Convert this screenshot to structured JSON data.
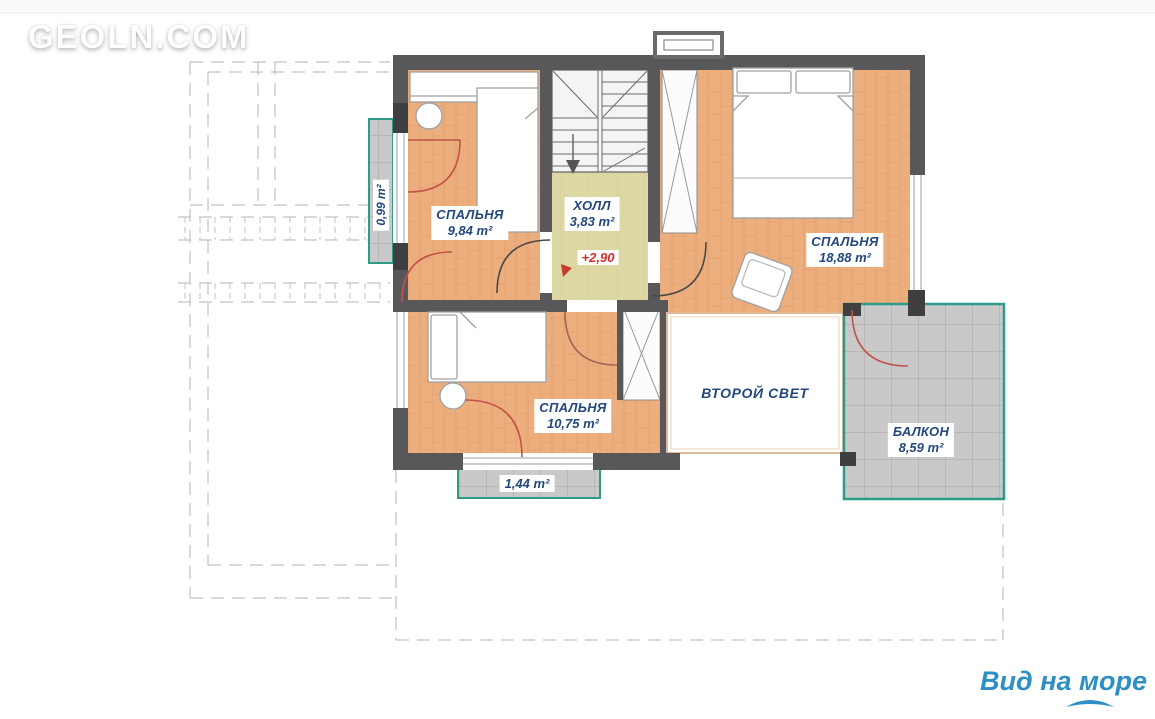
{
  "watermark": {
    "text": "GEOLN.COM"
  },
  "plan": {
    "rooms": {
      "bedroom_top_left": {
        "name": "СПАЛЬНЯ",
        "area": "9,84 m²"
      },
      "hall": {
        "name": "ХОЛЛ",
        "area": "3,83 m²"
      },
      "bedroom_right": {
        "name": "СПАЛЬНЯ",
        "area": "18,88 m²"
      },
      "bedroom_bottom": {
        "name": "СПАЛЬНЯ",
        "area": "10,75 m²"
      },
      "second_light": {
        "name": "ВТОРОЙ СВЕТ"
      },
      "balcony_right": {
        "name": "БАЛКОН",
        "area": "8,59 m²"
      },
      "balcony_left": {
        "area": "0,99 m²"
      },
      "balcony_bottom": {
        "area": "1,44 m²"
      }
    },
    "elevation_mark": "+2,90",
    "colors": {
      "wall": "#58585a",
      "wall_stub": "#3f3f41",
      "wood_floor": "#ecae7d",
      "hall_floor": "#ddd7a4",
      "tile_floor": "#c9c9c9",
      "balcony_border": "#2d9c86",
      "label_text": "#24477e",
      "elevation_text": "#d42b2b",
      "door_arc_red": "#c0524a",
      "footer_text": "#2d8fc3"
    }
  },
  "footer": {
    "caption": "Вид на море"
  }
}
